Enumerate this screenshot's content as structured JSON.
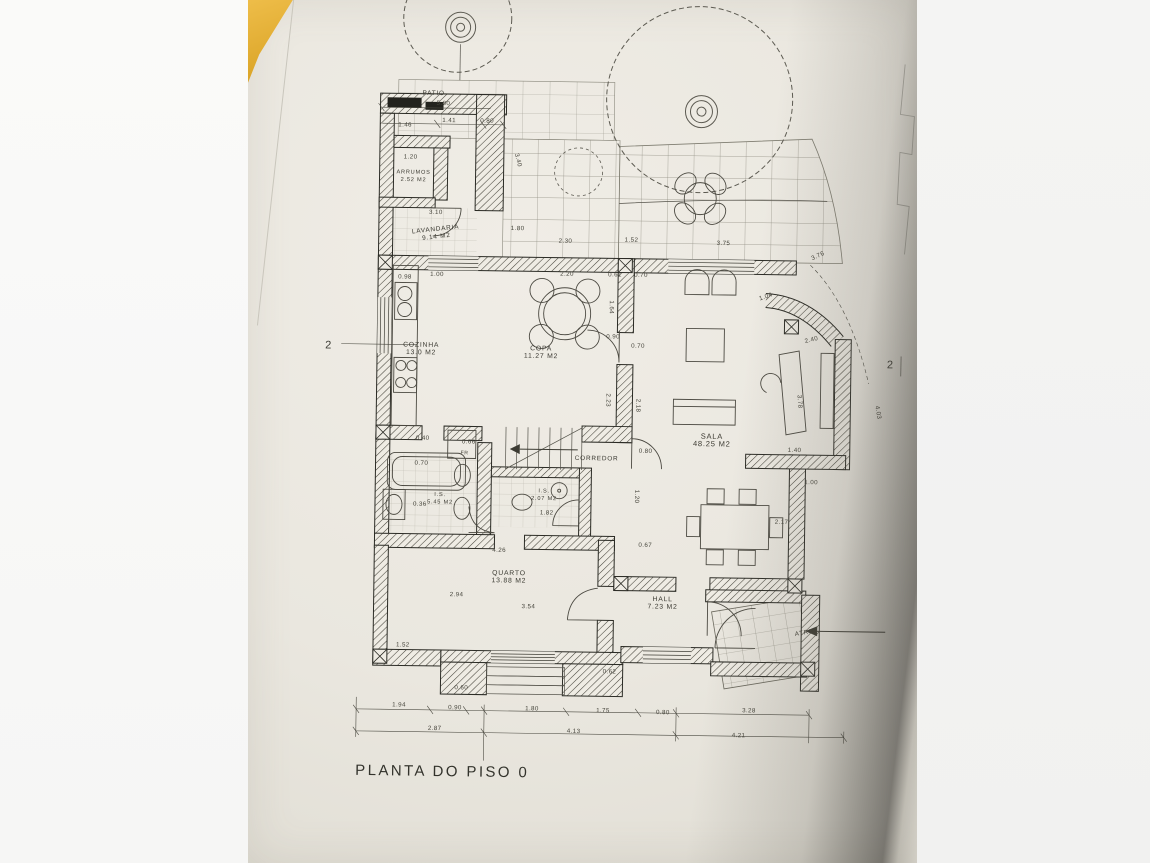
{
  "plan": {
    "title": "PLANTA DO PISO 0",
    "section_marker_left": "2",
    "section_marker_right": "2",
    "rooms": [
      {
        "name": "PATIO",
        "area": "",
        "x": 181,
        "y": 97,
        "s": 6.4
      },
      {
        "name": "ARRUMOS",
        "area": "2.52 M2",
        "x": 162,
        "y": 176,
        "s": 5.6
      },
      {
        "name": "LAVANDARIA",
        "area": "9.14 M2",
        "x": 185,
        "y": 233,
        "s": 6.4,
        "r": -7
      },
      {
        "name": "COZINHA",
        "area": "13.0 M2",
        "x": 172,
        "y": 349,
        "s": 6.8
      },
      {
        "name": "COPA",
        "area": "11.27 M2",
        "x": 292,
        "y": 351,
        "s": 6.8
      },
      {
        "name": "SALA",
        "area": "48.25 M2",
        "x": 464,
        "y": 437,
        "s": 7.5
      },
      {
        "name": "CORREDOR",
        "area": "",
        "x": 349,
        "y": 460,
        "s": 6.4
      },
      {
        "name": "I.S.",
        "area": "5.45 M2",
        "x": 193,
        "y": 498,
        "s": 5.6
      },
      {
        "name": "I.S.",
        "area": "2.07 M2",
        "x": 297,
        "y": 493,
        "s": 5.6
      },
      {
        "name": "QUARTO",
        "area": "13.88 M2",
        "x": 263,
        "y": 576,
        "s": 6.8
      },
      {
        "name": "HALL",
        "area": "7.23 M2",
        "x": 417,
        "y": 600,
        "s": 6.8
      },
      {
        "name": "ATRIO",
        "area": "",
        "x": 561,
        "y": 631,
        "s": 6.2,
        "r": -10
      }
    ],
    "dimension_labels": [
      {
        "t": "5.80",
        "x": 184,
        "y": 107
      },
      {
        "t": "1.46",
        "x": 146,
        "y": 129
      },
      {
        "t": "1.41",
        "x": 190,
        "y": 124
      },
      {
        "t": "0.80",
        "x": 228,
        "y": 124
      },
      {
        "t": "1.20",
        "x": 152,
        "y": 161
      },
      {
        "t": "3.40",
        "x": 263,
        "y": 155,
        "r": 75
      },
      {
        "t": "3.10",
        "x": 178,
        "y": 216
      },
      {
        "t": "1.80",
        "x": 260,
        "y": 231
      },
      {
        "t": "2.30",
        "x": 308,
        "y": 243
      },
      {
        "t": "1.52",
        "x": 374,
        "y": 241
      },
      {
        "t": "3.75",
        "x": 466,
        "y": 243
      },
      {
        "t": "3.76",
        "x": 562,
        "y": 257,
        "r": -25
      },
      {
        "t": "0.98",
        "x": 148,
        "y": 281
      },
      {
        "t": "1.00",
        "x": 180,
        "y": 278
      },
      {
        "t": "2.20",
        "x": 310,
        "y": 276
      },
      {
        "t": "0.61",
        "x": 358,
        "y": 276
      },
      {
        "t": "0.70",
        "x": 384,
        "y": 276
      },
      {
        "t": "1.64",
        "x": 360,
        "y": 300,
        "r": 90
      },
      {
        "t": "0.90",
        "x": 357,
        "y": 338
      },
      {
        "t": "0.70",
        "x": 382,
        "y": 347
      },
      {
        "t": "2.23",
        "x": 358,
        "y": 393,
        "r": 90
      },
      {
        "t": "2.18",
        "x": 388,
        "y": 398,
        "r": 90
      },
      {
        "t": "1.04",
        "x": 510,
        "y": 298,
        "r": -20
      },
      {
        "t": "2.40",
        "x": 556,
        "y": 340,
        "r": -15
      },
      {
        "t": "3.78",
        "x": 549,
        "y": 392,
        "r": 85
      },
      {
        "t": "1.40",
        "x": 540,
        "y": 449
      },
      {
        "t": "1.00",
        "x": 557,
        "y": 481
      },
      {
        "t": "2.17",
        "x": 528,
        "y": 521
      },
      {
        "t": "0.80",
        "x": 391,
        "y": 452
      },
      {
        "t": "1.20",
        "x": 388,
        "y": 489,
        "r": 90
      },
      {
        "t": "0.67",
        "x": 392,
        "y": 546
      },
      {
        "t": "0.40",
        "x": 168,
        "y": 442
      },
      {
        "t": "0.66",
        "x": 214,
        "y": 445
      },
      {
        "t": "0.70",
        "x": 167,
        "y": 467
      },
      {
        "t": "0.36",
        "x": 166,
        "y": 508
      },
      {
        "t": "1.82",
        "x": 293,
        "y": 515
      },
      {
        "t": "FR",
        "x": 213,
        "y": 456,
        "s": 5.2
      },
      {
        "t": "4.26",
        "x": 246,
        "y": 553
      },
      {
        "t": "2.94",
        "x": 204,
        "y": 598
      },
      {
        "t": "3.54",
        "x": 276,
        "y": 609
      },
      {
        "t": "0.62",
        "x": 358,
        "y": 673
      },
      {
        "t": "1.52",
        "x": 151,
        "y": 649
      },
      {
        "t": "0.60",
        "x": 210,
        "y": 691
      },
      {
        "t": "4.03",
        "x": 627,
        "y": 402,
        "r": 80
      },
      {
        "t": "1.94",
        "x": 148,
        "y": 709
      },
      {
        "t": "0.90",
        "x": 204,
        "y": 711
      },
      {
        "t": "1.80",
        "x": 281,
        "y": 711
      },
      {
        "t": "1.75",
        "x": 352,
        "y": 712
      },
      {
        "t": "0.80",
        "x": 412,
        "y": 713
      },
      {
        "t": "3.28",
        "x": 498,
        "y": 710
      },
      {
        "t": "2.87",
        "x": 184,
        "y": 732
      },
      {
        "t": "4.13",
        "x": 323,
        "y": 733
      },
      {
        "t": "4.21",
        "x": 488,
        "y": 735
      }
    ]
  }
}
